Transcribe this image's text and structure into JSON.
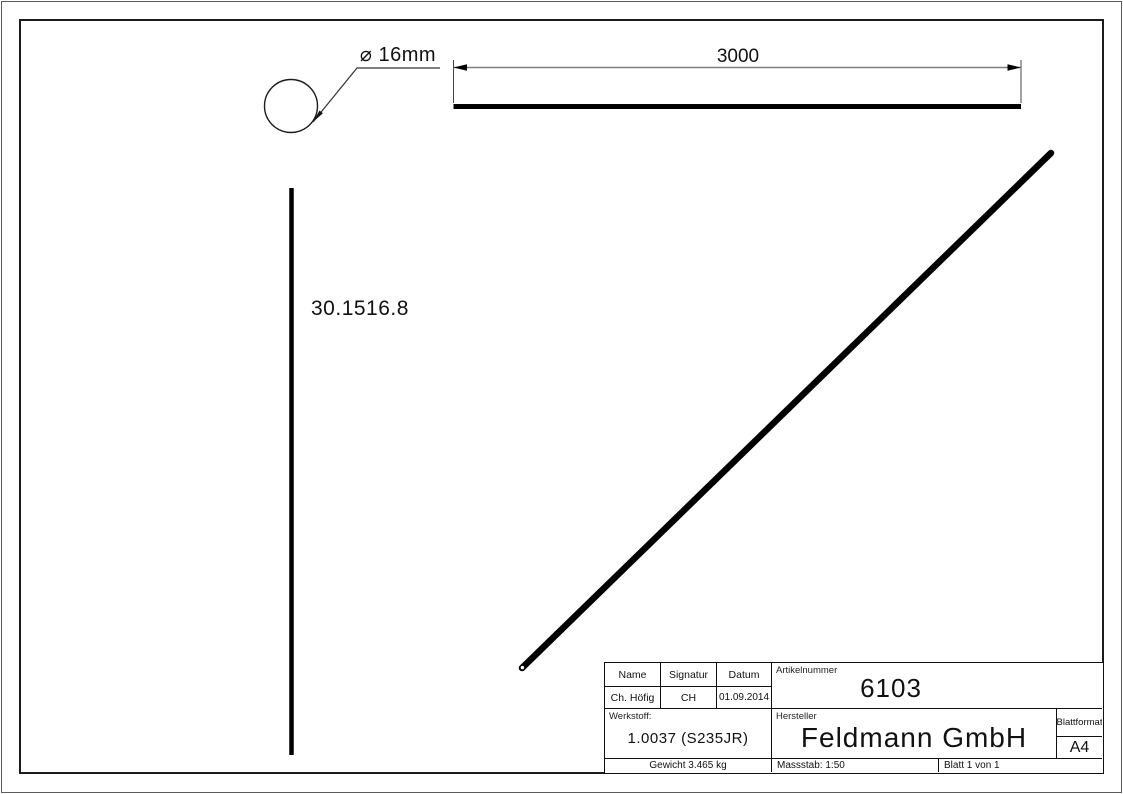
{
  "drawing": {
    "annotations": {
      "diameter_label": "⌀ 16mm",
      "length_dimension": "3000",
      "part_number_label": "30.1516.8"
    },
    "title_block": {
      "header_row": {
        "name": "Name",
        "signature": "Signatur",
        "date": "Datum"
      },
      "value_row": {
        "name": "Ch. Höfig",
        "signature": "CH",
        "date": "01.09.2014"
      },
      "article_number": {
        "label": "Artikelnummer",
        "value": "6103"
      },
      "material": {
        "label": "Werkstoff:",
        "value": "1.0037 (S235JR)"
      },
      "manufacturer": {
        "label": "Hersteller",
        "value": "Feldmann GmbH"
      },
      "sheet_format": {
        "label": "Blattformat",
        "value": "A4"
      },
      "weight": "Gewicht 3.465 kg",
      "scale": "Massstab: 1:50",
      "sheet_number": "Blatt 1 von 1"
    },
    "colors": {
      "part_line": "#000000",
      "frame": "#1c1c1c",
      "dimension_line": "#808080",
      "extension_line": "#444444",
      "leader_line": "#333333"
    }
  }
}
